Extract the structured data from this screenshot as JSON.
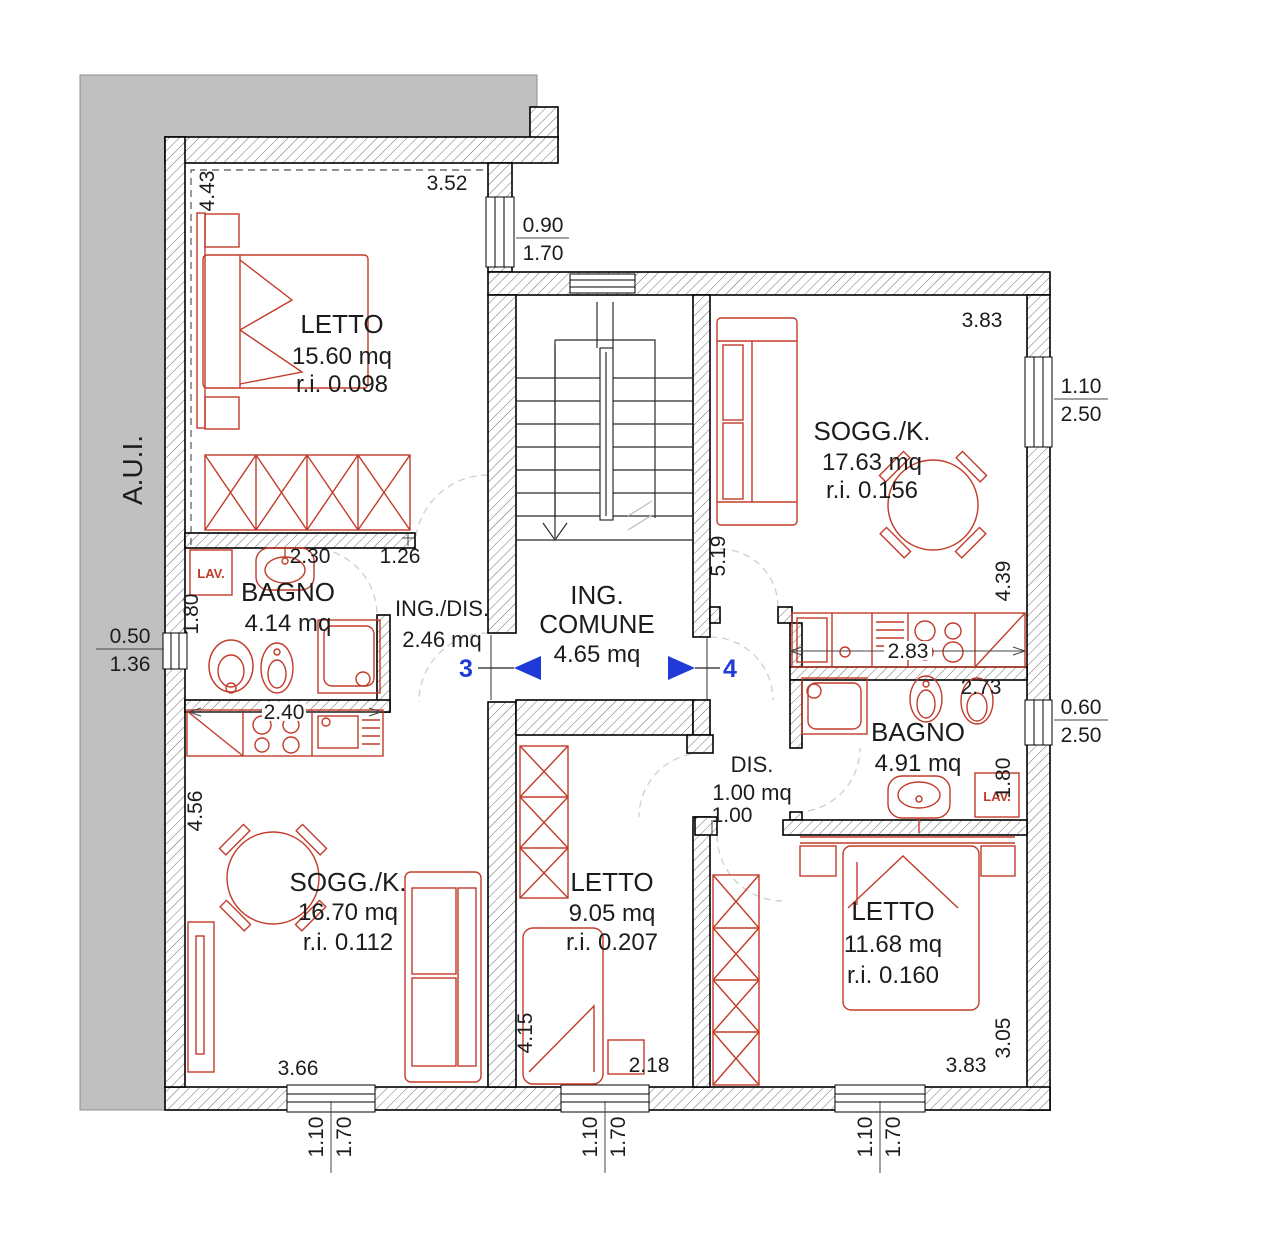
{
  "plan": {
    "aui": "A.U.I.",
    "markers": {
      "left": "3",
      "right": "4"
    },
    "rooms": {
      "letto_nw": {
        "name": "LETTO",
        "area": "15.60 mq",
        "ri": "r.i. 0.098"
      },
      "sogg_ne": {
        "name": "SOGG./K.",
        "area": "17.63 mq",
        "ri": "r.i. 0.156"
      },
      "bagno_w": {
        "name": "BAGNO",
        "area": "4.14 mq"
      },
      "ing_dis": {
        "name": "ING./DIS.",
        "area": "2.46 mq"
      },
      "ing_comune": {
        "line1": "ING.",
        "line2": "COMUNE",
        "area": "4.65 mq"
      },
      "dis_e": {
        "name": "DIS.",
        "area": "1.00 mq",
        "dim": "1.00"
      },
      "bagno_e": {
        "name": "BAGNO",
        "area": "4.91 mq"
      },
      "sogg_sw": {
        "name": "SOGG./K.",
        "area": "16.70 mq",
        "ri": "r.i. 0.112"
      },
      "letto_s": {
        "name": "LETTO",
        "area": "9.05 mq",
        "ri": "r.i. 0.207"
      },
      "letto_se": {
        "name": "LETTO",
        "area": "11.68 mq",
        "ri": "r.i. 0.160"
      }
    },
    "lav": {
      "west": "LAV.",
      "east": "LAV."
    },
    "dims": {
      "d443": "4.43",
      "d352": "3.52",
      "d383top": "3.83",
      "d519": "5.19",
      "d439": "4.39",
      "d230": "2.30",
      "d126": "1.26",
      "d180w": "1.80",
      "d240": "2.40",
      "d283": "2.83",
      "d273": "2.73",
      "d180e": "1.80",
      "d456": "4.56",
      "d415": "4.15",
      "d218": "2.18",
      "d366": "3.66",
      "d383bot": "3.83",
      "d305": "3.05"
    },
    "windows": {
      "w090": {
        "a": "0.90",
        "b": "1.70"
      },
      "w110_250": {
        "a": "1.10",
        "b": "2.50"
      },
      "w050": {
        "a": "0.50",
        "b": "1.36"
      },
      "w060": {
        "a": "0.60",
        "b": "2.50"
      },
      "w110a": {
        "a": "1.10",
        "b": "1.70"
      },
      "w110b": {
        "a": "1.10",
        "b": "1.70"
      },
      "w110c": {
        "a": "1.10",
        "b": "1.70"
      }
    },
    "colors": {
      "furniture": "#c23b2a",
      "marker_blue": "#1f3ad6",
      "site_mass": "#c0c0c0"
    }
  }
}
